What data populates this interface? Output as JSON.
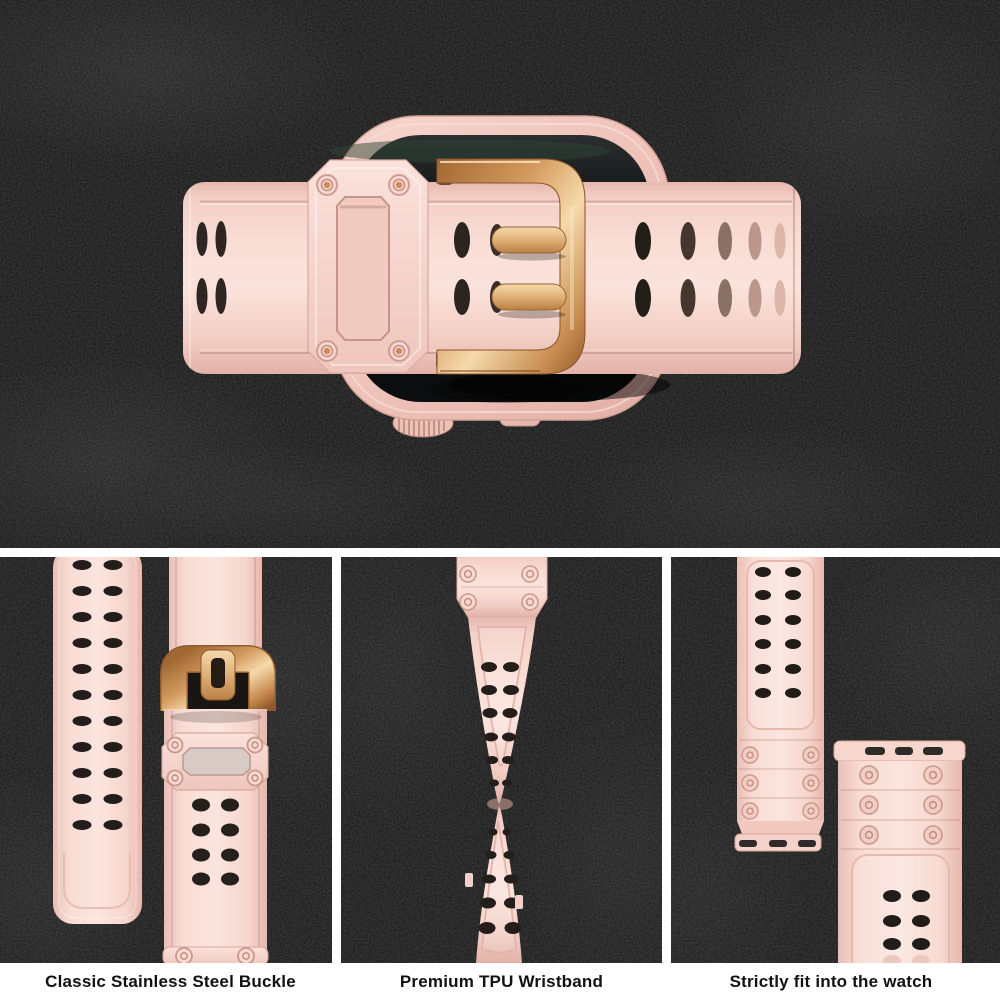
{
  "captions": {
    "panel1": "Classic Stainless Steel Buckle",
    "panel2": "Premium TPU Wristband",
    "panel3": "Strictly fit into the watch"
  },
  "colors": {
    "band_pink": "#f8dcd4",
    "band_pink_light": "#fbe6df",
    "band_pink_shadow": "#e4b5ab",
    "buckle_gold": "#d49b5e",
    "buckle_gold_light": "#f6d9ab",
    "buckle_gold_dark": "#8f5a2c",
    "watch_case_pink": "#eec3ba",
    "screen_black": "#0a0b0c",
    "background": "#141414",
    "caption_bar": "#ffffff",
    "caption_text": "#111111"
  }
}
